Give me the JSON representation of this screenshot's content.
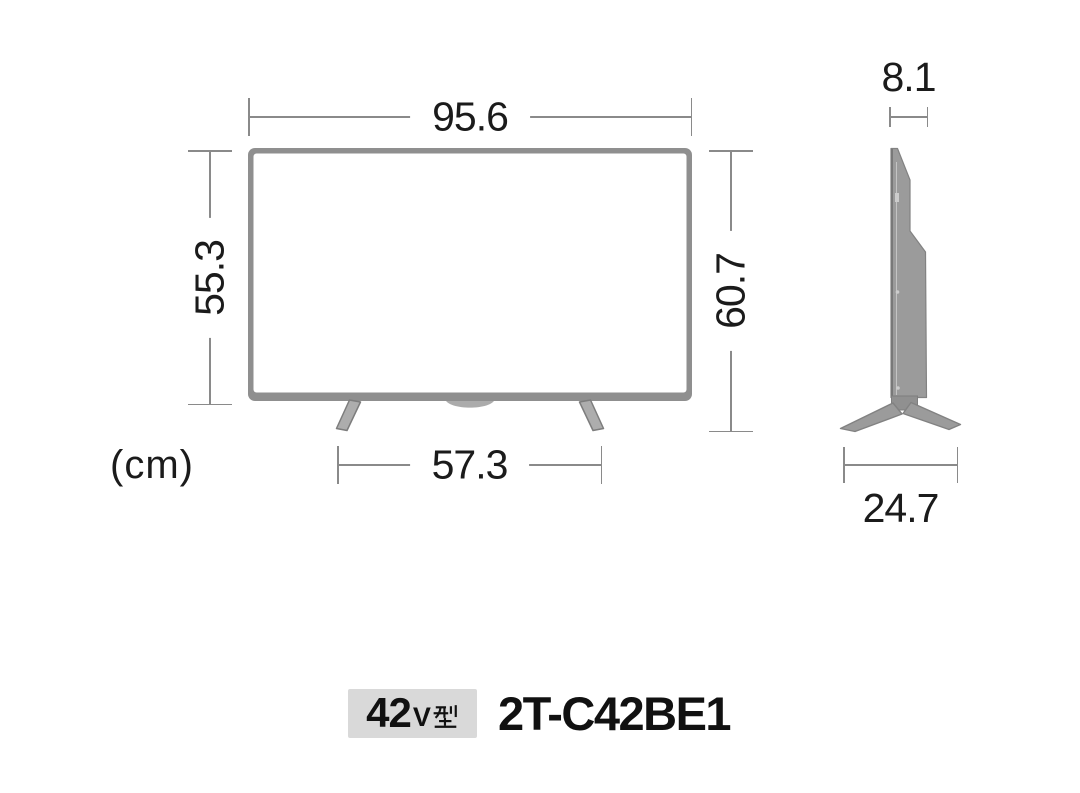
{
  "unit_note": "(cm)",
  "dimensions": {
    "width_cm": "95.6",
    "panel_height_cm": "55.3",
    "total_height_cm": "60.7",
    "stand_width_cm": "57.3",
    "depth_cm": "8.1",
    "stand_depth_cm": "24.7"
  },
  "product": {
    "screen_size_number": "42",
    "screen_size_unit_latin": "V",
    "screen_size_unit_kanji": "型",
    "model_number": "2T-C42BE1"
  },
  "colors": {
    "background": "#ffffff",
    "dim_line": "#8a8a8a",
    "dim_text": "#1b1b1b",
    "tv_frame": "#8f8f8f",
    "tv_screen": "#ffffff",
    "tv_chin": "#ababab",
    "leg_fill": "#adadad",
    "leg_edge": "#7d7d7d",
    "side_fill": "#9b9b9b",
    "side_edge": "#828282",
    "badge_bg": "#d9d9d9",
    "model_text": "#111111"
  }
}
